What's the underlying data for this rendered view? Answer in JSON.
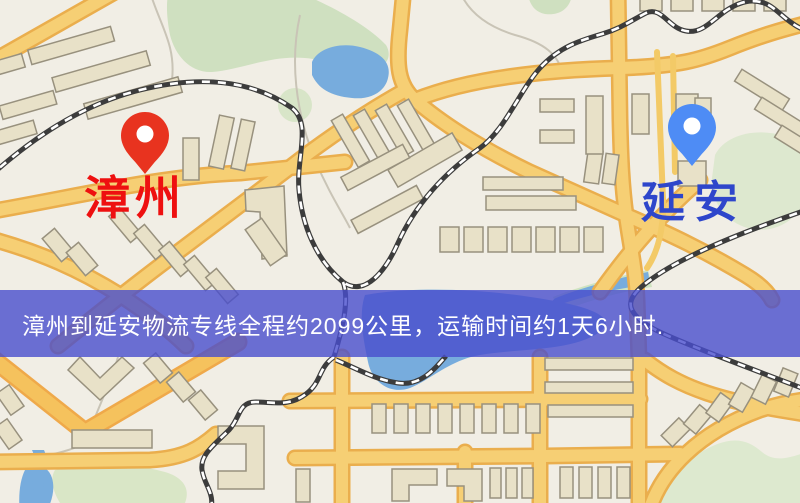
{
  "window": {
    "width": 800,
    "height": 503,
    "kind": "logistics-route-map"
  },
  "map": {
    "type": "stylized-city-map",
    "markers": [
      {
        "id": "origin",
        "label": "漳州",
        "label_color": "#ee1010",
        "pin_color": "#e8331f"
      },
      {
        "id": "destination",
        "label": "延安",
        "label_color": "#2e46cb",
        "pin_color": "#4e8cf5"
      }
    ],
    "banner": {
      "text": "漳州到延安物流专线全程约2099公里，运输时间约1天6小时.",
      "background": "#494dcd",
      "opacity": 0.8,
      "text_color": "#ffffff"
    },
    "route": {
      "from": "漳州",
      "to": "延安",
      "distance_km": "2099",
      "duration": "1天6小时"
    },
    "palette": {
      "background": "#f1eee5",
      "road": "#f6cf74",
      "road_casing": "#eaae4d",
      "highway": "#f5c25d",
      "building": "#e8e1c8",
      "building_outline": "#98917e",
      "park": "#cfe0c0",
      "water": "#77acdd",
      "railway": "#3c3c3c"
    }
  }
}
